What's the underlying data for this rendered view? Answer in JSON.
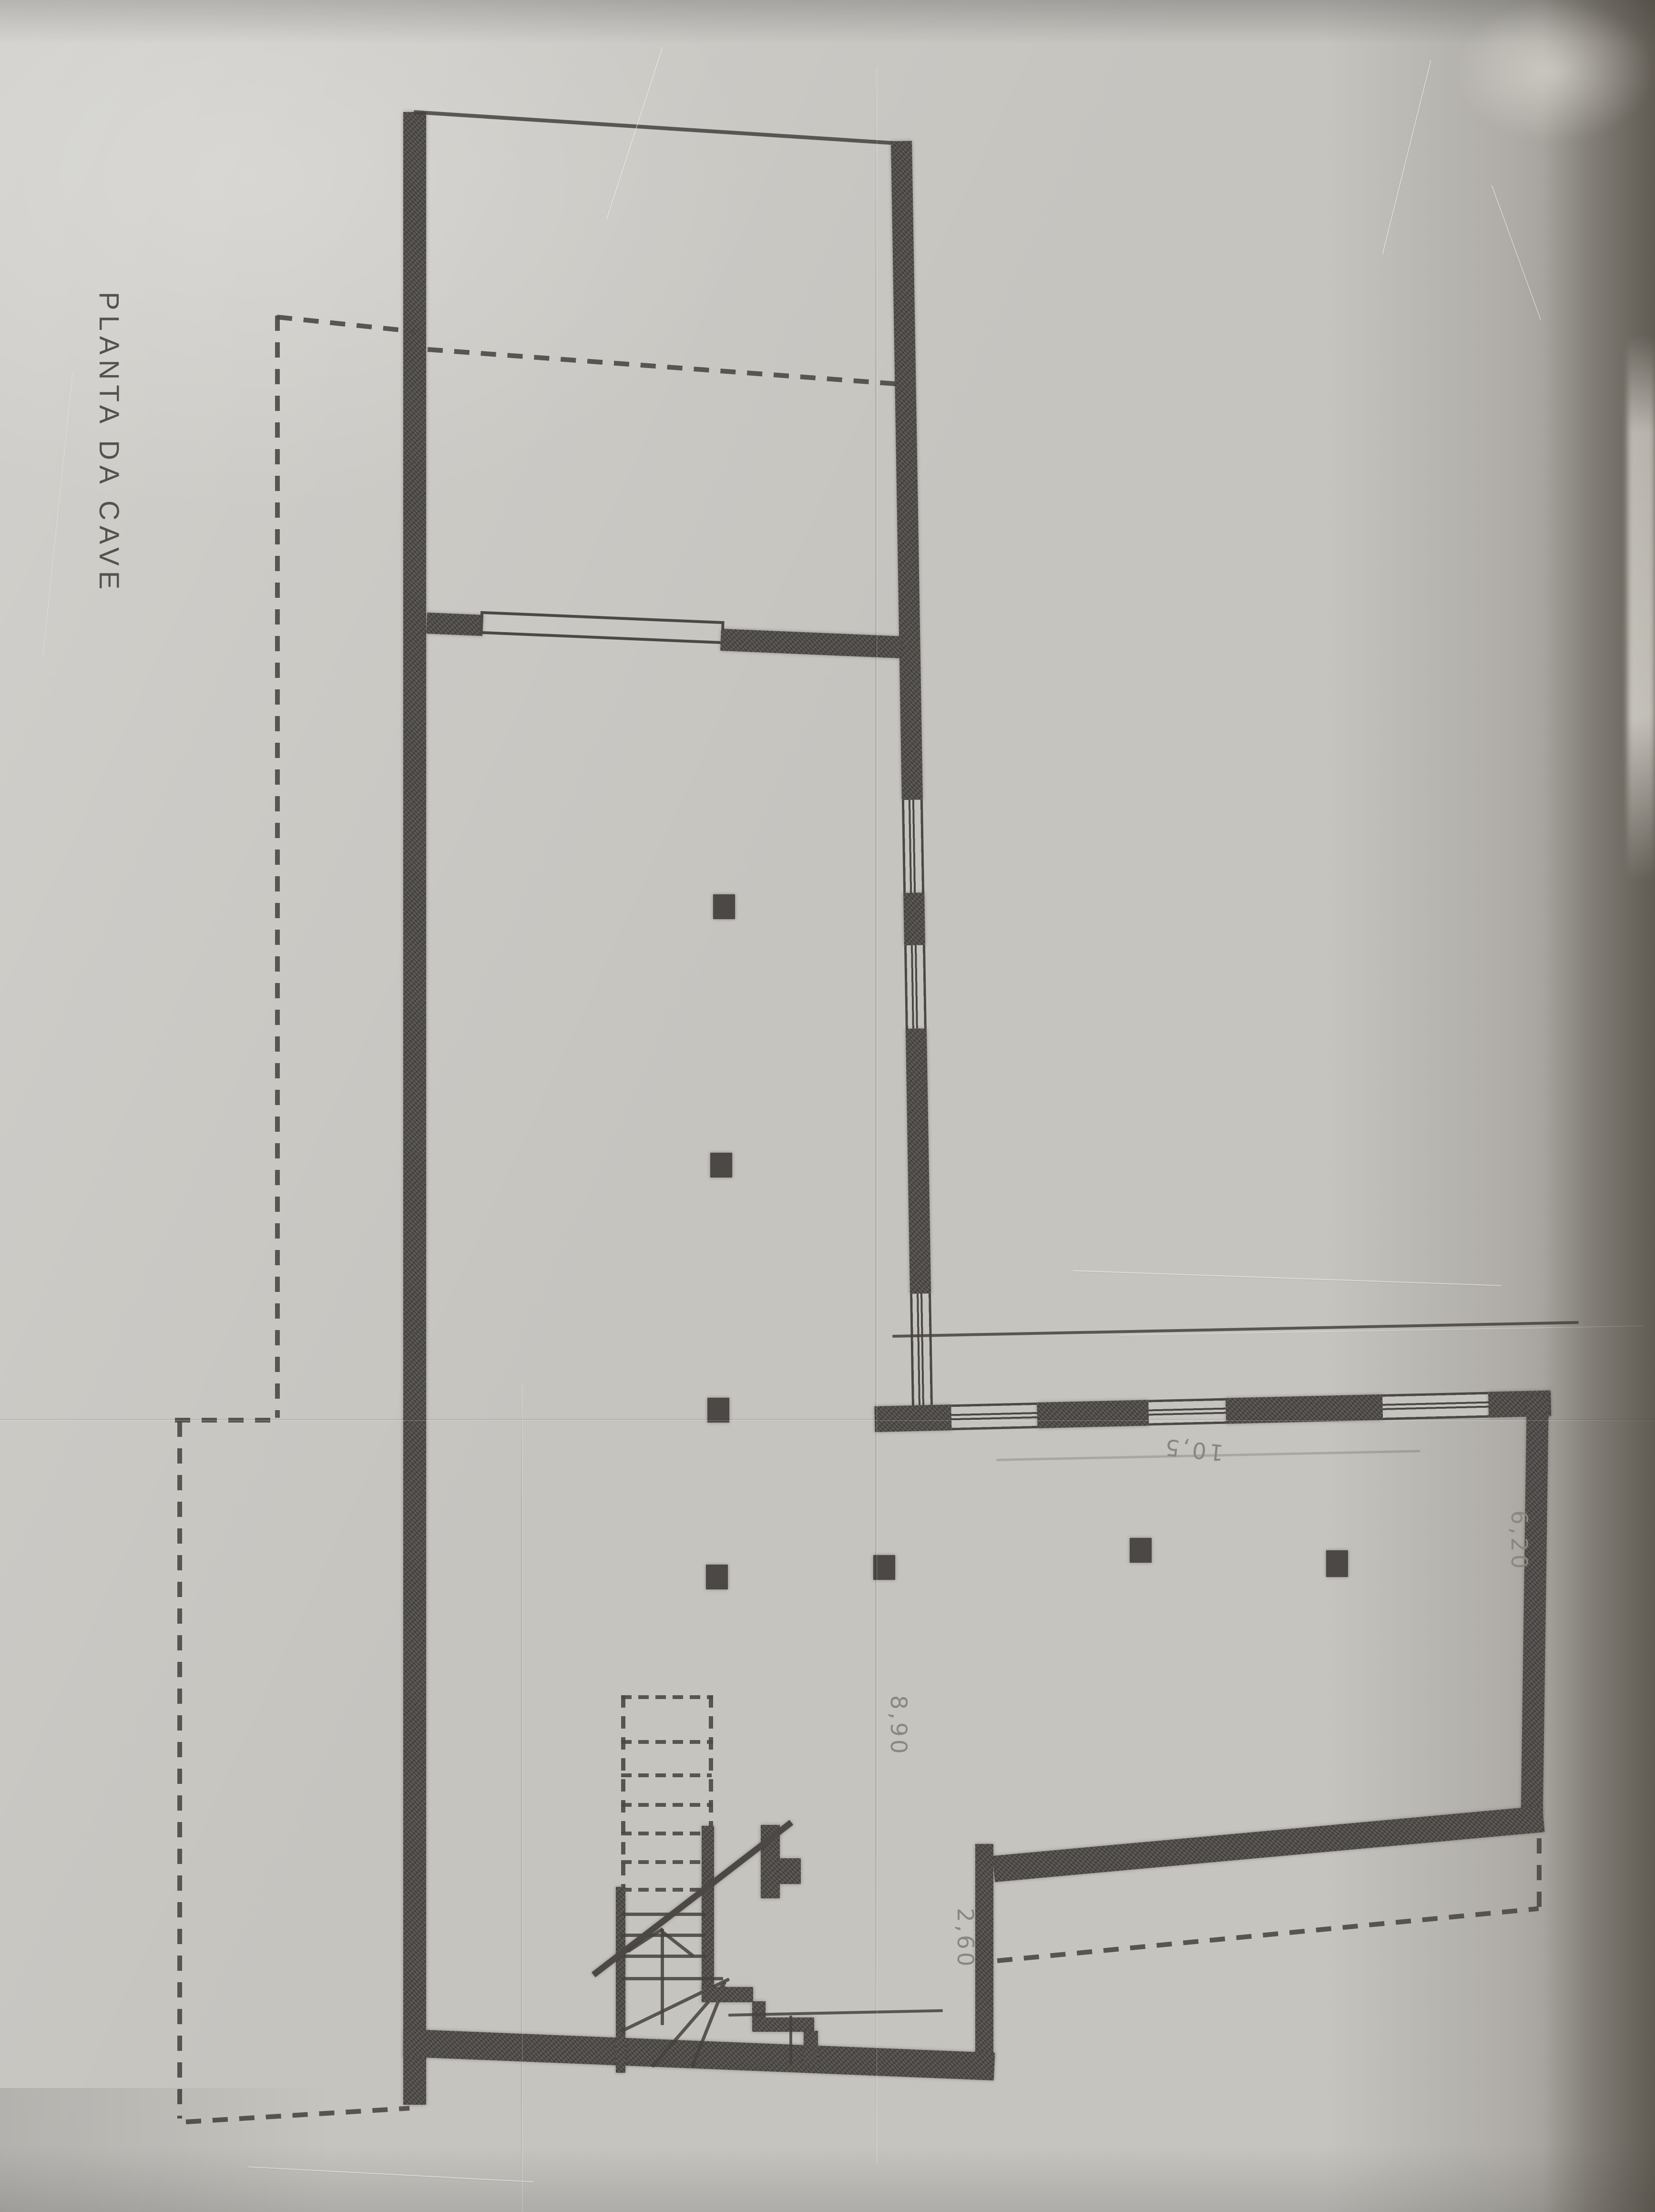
{
  "sheet": {
    "title": "PLANTA DA CAVE"
  },
  "dims": {
    "wing_length": "10,5",
    "wing_depth": "6,20",
    "hall_width": "8,90",
    "annex_width": "2,60"
  },
  "colors": {
    "paper": "#c6c4bf",
    "ink": "#4b4845",
    "pencil": "#8a8680"
  }
}
